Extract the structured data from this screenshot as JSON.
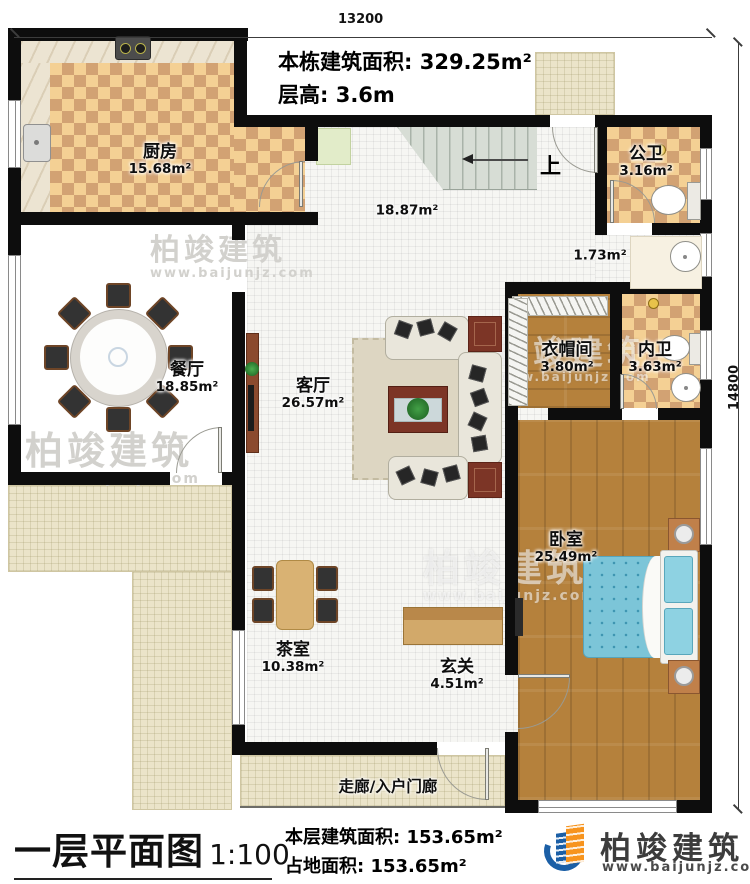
{
  "dimensions": {
    "top": "13200",
    "right": "14800"
  },
  "header": {
    "building_area_label": "本栋建筑面积:",
    "building_area_value": "329.25m²",
    "floor_height_label": "层高:",
    "floor_height_value": "3.6m"
  },
  "rooms": {
    "kitchen": {
      "name": "厨房",
      "area": "15.68m²"
    },
    "public_bath": {
      "name": "公卫",
      "area": "3.16m²"
    },
    "hallway": {
      "area": "18.87m²"
    },
    "wash_area": {
      "area": "1.73m²"
    },
    "dining": {
      "name": "餐厅",
      "area": "18.85m²"
    },
    "living": {
      "name": "客厅",
      "area": "26.57m²"
    },
    "cloakroom": {
      "name": "衣帽间",
      "area": "3.80m²"
    },
    "inner_bath": {
      "name": "内卫",
      "area": "3.63m²"
    },
    "bedroom": {
      "name": "卧室",
      "area": "25.49m²"
    },
    "tea_room": {
      "name": "茶室",
      "area": "10.38m²"
    },
    "foyer": {
      "name": "玄关",
      "area": "4.51m²"
    },
    "corridor": {
      "name": "走廊/入户门廊"
    }
  },
  "stairs": {
    "up_label": "上"
  },
  "footer": {
    "title": "一层平面图",
    "scale": "1:100",
    "floor_area_label": "本层建筑面积:",
    "floor_area_value": "153.65m²",
    "land_area_label": "占地面积:",
    "land_area_value": "153.65m²",
    "brand": "柏竣建筑",
    "website": "www.baijunjz.com"
  },
  "watermark": {
    "brand": "柏竣建筑",
    "website": "www.baijunjz.com"
  },
  "colors": {
    "wall": "#0d0d0d",
    "checker_light": "#f4d094",
    "checker_dark": "#d2a273",
    "wood": "#b5813c",
    "terrace": "#ebe4c9",
    "bed_blue": "#7cc5d8",
    "brand_blue": "#1b5fa6",
    "brand_orange": "#f7941e"
  }
}
